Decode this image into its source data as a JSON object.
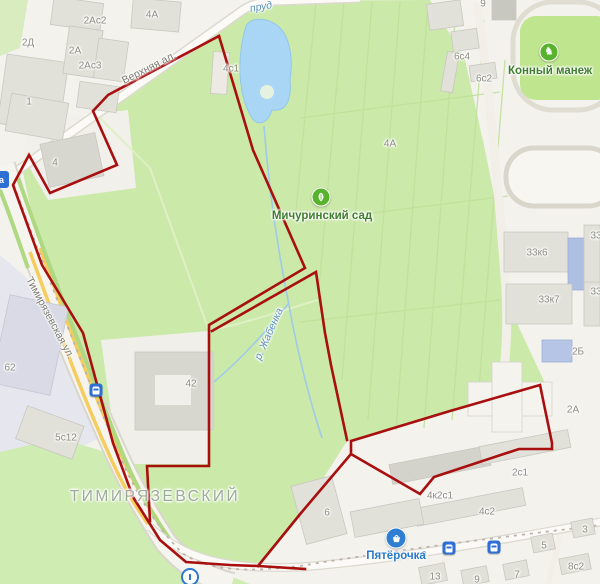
{
  "map": {
    "colors": {
      "boundary": "#a80f0f",
      "park_green": "#cbe9a9",
      "water_blue": "#a9d6f5",
      "poi_green": "#57b32c",
      "poi_blue": "#2e7fd2"
    },
    "boundary": {
      "width": 2.6,
      "paths": [
        [
          [
            219,
            36
          ],
          [
            253,
            150
          ],
          [
            305,
            268
          ],
          [
            209,
            325
          ],
          [
            209,
            466
          ],
          [
            147,
            466
          ],
          [
            150,
            521
          ]
        ],
        [
          [
            219,
            36
          ],
          [
            108,
            95
          ],
          [
            93,
            111
          ],
          [
            117,
            165
          ],
          [
            50,
            193
          ],
          [
            29,
            155
          ],
          [
            13,
            185
          ],
          [
            42,
            265
          ],
          [
            83,
            333
          ],
          [
            113,
            443
          ],
          [
            133,
            497
          ],
          [
            160,
            540
          ],
          [
            186,
            562
          ],
          [
            230,
            565
          ],
          [
            258,
            566
          ],
          [
            305,
            569
          ]
        ],
        [
          [
            258,
            566
          ],
          [
            301,
            513
          ],
          [
            351,
            454
          ],
          [
            351,
            441
          ],
          [
            450,
            411
          ],
          [
            540,
            385
          ],
          [
            552,
            443
          ],
          [
            552,
            449
          ],
          [
            519,
            449
          ],
          [
            434,
            477
          ],
          [
            420,
            494
          ],
          [
            351,
            454
          ]
        ],
        [
          [
            212,
            331
          ],
          [
            316,
            272
          ],
          [
            325,
            333
          ],
          [
            331,
            365
          ],
          [
            347,
            440
          ]
        ]
      ]
    },
    "district_label": {
      "text": "ТИМИРЯЗЕВСКИЙ",
      "x": 155,
      "y": 497
    },
    "street_labels": [
      {
        "text": "Верхняя ал.",
        "x": 149,
        "y": 68,
        "rot": -27
      },
      {
        "text": "Тимирязевская ул.",
        "x": 50,
        "y": 318,
        "rot": 62
      }
    ],
    "water_labels": [
      {
        "text": "пруд",
        "x": 261,
        "y": 7,
        "rot": -10
      },
      {
        "text": "р. Жабенка",
        "x": 269,
        "y": 334,
        "rot": -66
      }
    ],
    "building_labels": [
      {
        "text": "2Ас2",
        "x": 95,
        "y": 21
      },
      {
        "text": "4А",
        "x": 152,
        "y": 15
      },
      {
        "text": "2Д",
        "x": 28,
        "y": 43
      },
      {
        "text": "2А",
        "x": 75,
        "y": 51
      },
      {
        "text": "2Ас3",
        "x": 90,
        "y": 66
      },
      {
        "text": "1",
        "x": 29,
        "y": 102
      },
      {
        "text": "4",
        "x": 55,
        "y": 163
      },
      {
        "text": "4с1",
        "x": 231,
        "y": 69
      },
      {
        "text": "9",
        "x": 483,
        "y": 4
      },
      {
        "text": "6с4",
        "x": 462,
        "y": 57
      },
      {
        "text": "6с2",
        "x": 484,
        "y": 79
      },
      {
        "text": "4А",
        "x": 390,
        "y": 144
      },
      {
        "text": "33",
        "x": 596,
        "y": 236
      },
      {
        "text": "33к6",
        "x": 537,
        "y": 253
      },
      {
        "text": "33",
        "x": 596,
        "y": 292
      },
      {
        "text": "33к7",
        "x": 549,
        "y": 300
      },
      {
        "text": "2Б",
        "x": 578,
        "y": 352
      },
      {
        "text": "2А",
        "x": 573,
        "y": 410
      },
      {
        "text": "62",
        "x": 10,
        "y": 368
      },
      {
        "text": "42",
        "x": 191,
        "y": 384
      },
      {
        "text": "5с12",
        "x": 66,
        "y": 438
      },
      {
        "text": "6",
        "x": 327,
        "y": 513
      },
      {
        "text": "2с1",
        "x": 520,
        "y": 473
      },
      {
        "text": "4к2с1",
        "x": 440,
        "y": 496
      },
      {
        "text": "4с2",
        "x": 487,
        "y": 512
      },
      {
        "text": "5",
        "x": 544,
        "y": 546
      },
      {
        "text": "3",
        "x": 585,
        "y": 530
      },
      {
        "text": "7",
        "x": 517,
        "y": 575
      },
      {
        "text": "9",
        "x": 477,
        "y": 580
      },
      {
        "text": "13",
        "x": 435,
        "y": 577
      },
      {
        "text": "8с2",
        "x": 576,
        "y": 567
      }
    ],
    "transit_letter": {
      "text": "a",
      "x": 424,
      "y": 553
    },
    "pois": [
      {
        "id": "michurinsky-garden",
        "label": "Мичуринский сад",
        "icon": "leaf",
        "icon_x": 321,
        "icon_y": 197,
        "label_x": 322,
        "label_y": 216
      },
      {
        "id": "horse-arena",
        "label": "Конный манеж",
        "icon": "horse",
        "icon_x": 549,
        "icon_y": 52,
        "label_x": 550,
        "label_y": 71
      },
      {
        "id": "pyaterochka",
        "label": "Пятёрочка",
        "icon": "basket",
        "icon_x": 396,
        "icon_y": 538,
        "label_x": 396,
        "label_y": 556
      }
    ],
    "transit_stops": [
      {
        "type": "tram-stop",
        "x": 96,
        "y": 390
      },
      {
        "type": "tram-stop",
        "x": 449,
        "y": 548
      },
      {
        "type": "tram-stop",
        "x": 494,
        "y": 547
      }
    ],
    "bus_stop_partial": {
      "letter": "a",
      "x": -6,
      "y": 171
    },
    "fountain": {
      "x": 190,
      "y": 577
    }
  }
}
